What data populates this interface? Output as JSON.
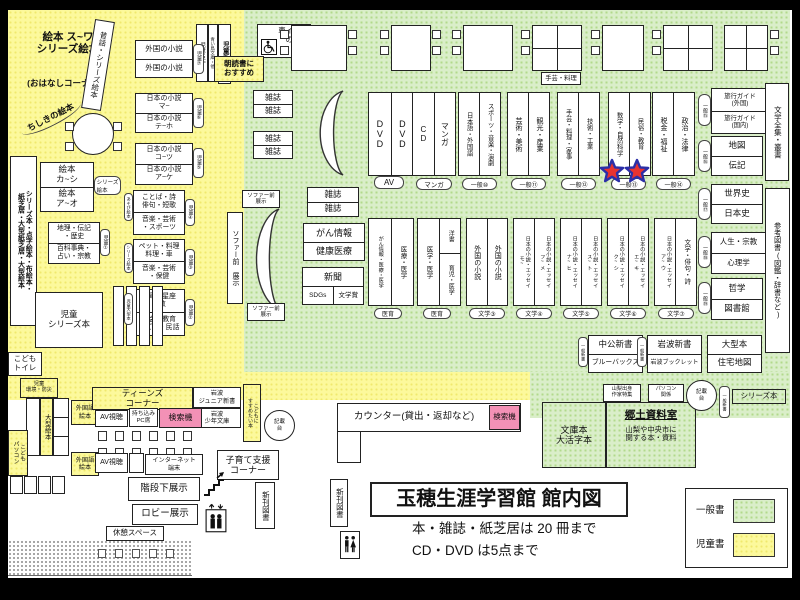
{
  "colors": {
    "children_bg": "#fcf99c",
    "general_bg": "#daeec9",
    "search_pink": "#f391b6",
    "star_red": "#e73330",
    "star_outline": "#2b2fa8"
  },
  "title": {
    "main": "玉穂生涯学習館 館内図",
    "note1": "本・雑誌・紙芝居は 20 冊まで",
    "note2": "CD・DVD は5点まで"
  },
  "legend": {
    "general": "一般書",
    "children": "児童書"
  },
  "misc": {
    "wheelchair_desk": "車イス用\nの机",
    "counter": "カウンター(貸出・返却など)",
    "search": "検索機",
    "kisaidai": "記載\n台",
    "magazine": "雑誌",
    "shinkan": "新刊図書",
    "kaidan": "階段下展示",
    "lobby": "ロビー展示",
    "kyukei": "休憩スペース"
  },
  "children": {
    "corner_title": "絵本 ス~ワ\nシリーズ絵本",
    "ohanashi": "(おはなしコーナー)",
    "mukashi": "昔話・シリーズ絵本",
    "chishiki": "ちしきの絵本",
    "meisaku": "児童名作",
    "aoitori": "青い鳥文庫・他",
    "shinsho": "児童新書",
    "asadoku": "朝読書に\nおすすめ",
    "s7r1": "外国の小説",
    "s7r2": "外国の小説",
    "s7tab": "児童⑦",
    "s6r1": "日本の小説\nマ~",
    "s6r2": "日本の小説\nテ~ホ",
    "s6tab": "児童⑥",
    "s5r1": "日本の小説\nコ~ツ",
    "s5r2": "日本の小説\nア~ケ",
    "s5tab": "児童⑤",
    "left_tall": "シリーズ本・点字絵本・布絵本・\n紙芝居・大型紙芝居・大型絵本",
    "ehon_r1": "絵本\nカ~シ",
    "ehon_r2": "絵本\nア~オ",
    "ehon_tab": "シリーズ\n絵本",
    "s1r1": "地理・伝記\n・歴史",
    "s1r2": "百科事典・\n占い・宗教",
    "s1tab": "児童①",
    "s4left": "あそび絵本",
    "s4r1": "ことば・詩\n俳句・短歌",
    "s4r2": "音楽・芸術\n・スポーツ",
    "s4tab": "児童④",
    "s3left": "シリーズ絵本",
    "s3r1": "ペット・料理\n料理・車",
    "s3r2": "音楽・芸術\n・保健",
    "s3tab": "児童③",
    "s2left": "児童大型本",
    "s2r1": "恐竜・星座\n算数",
    "s2r2": "社会・教育\nしごと・民話",
    "s2tab": "児童②",
    "series_box": "児童\nシリーズ本",
    "toilet": "こども\nトイレ",
    "kankyo": "児童\n環境・防災",
    "ogata_ehon": "大型絵本",
    "kids_pc": "こども\nパソコン"
  },
  "teens": {
    "foreign": "外国語\n絵本",
    "header": "ティーンズ\nコーナー",
    "av": "AV視聴",
    "pc_seat": "持ち込み\nPC席",
    "iwanami_jr": "岩波\nジュニア新書",
    "iwanami_shonen": "岩波\n少年文庫",
    "osusume": "こどもに\nすすめたい本",
    "internet": "インターネット\n端末",
    "kosodate": "子育て支援\nコーナー"
  },
  "general": {
    "sofa_v": "ソファー前 展示",
    "sofa_s": "ソファー前\n展示",
    "cancer1": "がん情報",
    "cancer2": "健康医療",
    "news": "新聞",
    "sdgs": "SDGs",
    "bungakusho": "文学賞",
    "craft_sign": "手芸・料理",
    "av_c1": "DVD",
    "av_c2": "DVD",
    "av_label": "AV",
    "cd_c1": "CD",
    "cd_c2": "マンガ",
    "cd_label": "マンガ",
    "g10c1": "日本語・外国語",
    "g10c2": "スポーツ・音楽・演劇",
    "g10": "一般⑩",
    "g11c1": "芸術・美術",
    "g11c2": "観光・産業",
    "g11": "一般⑪",
    "g12c1": "手芸・料理・家事",
    "g12c2": "技術・工業",
    "g12": "一般⑫",
    "g13c1": "数学・自然科学",
    "g13c2": "民俗・教育",
    "g13": "一般⑬",
    "g14c1": "税金・福祉",
    "g14c2": "政治・法律",
    "g14": "一般⑭",
    "g15r1": "旅行ガイド\n(外国)",
    "g15r2": "旅行ガイド\n(国内)",
    "g15": "一般⑮",
    "g16r1": "地図",
    "g16r2": "伝記",
    "g16": "一般⑯",
    "g17r1": "世界史",
    "g17r2": "日本史",
    "g17": "一般⑰",
    "g18r1": "人生・宗教",
    "g18r2": "心理学",
    "g18": "一般⑱",
    "g19r1": "哲学",
    "g19r2": "図書館",
    "g19": "一般⑲",
    "zenshu": "文学全集・叢書",
    "sanko": "参考図書(図鑑・辞書など)",
    "med1c1": "がん情報・医療・医学",
    "med1c2": "医療・医学",
    "med1": "医育",
    "med2c1": "医学・医学",
    "med2c2a": "洋書",
    "med2c2b": "育児・医学",
    "med2": "医育",
    "lit3c1": "外国の小説",
    "lit3c2": "外国の小説",
    "lit3": "文学③",
    "lit4c1": "日本の小説・エッセイ\nモ~",
    "lit4c2": "日本の小説・エッセイ\nフ~メ",
    "lit4": "文学④",
    "lit5c1": "日本の小説・エッセイ\nナ~ヒ",
    "lit5c2": "日本の小説・エッセイ\nス~ト",
    "lit5": "文学⑤",
    "lit6c1": "日本の小説・エッセイ\nク~シ",
    "lit6c2": "日本の小説・エッセイ\nエ~キ",
    "lit6": "文学⑥",
    "lit7c1": "日本の小説・エッセイ\nア~ウ",
    "lit7c2": "文学・俳句・詩",
    "lit7": "文学⑦"
  },
  "newbooks": {
    "tab": "一般新書",
    "chuko1": "中公新書",
    "chuko2": "ブルーバックス",
    "iwanami1": "岩波新書",
    "iwanami2": "岩波ブックレット",
    "ogata1": "大型本",
    "ogata2": "住宅地図",
    "yamanashi": "山梨出身\n作家特集",
    "pc": "パソコン\n関係",
    "series": "シリーズ本",
    "bunko": "文庫本\n大活字本",
    "kyodo_title": "郷土資料室",
    "kyodo_desc": "山梨や中央市に\n関する本・資料"
  }
}
